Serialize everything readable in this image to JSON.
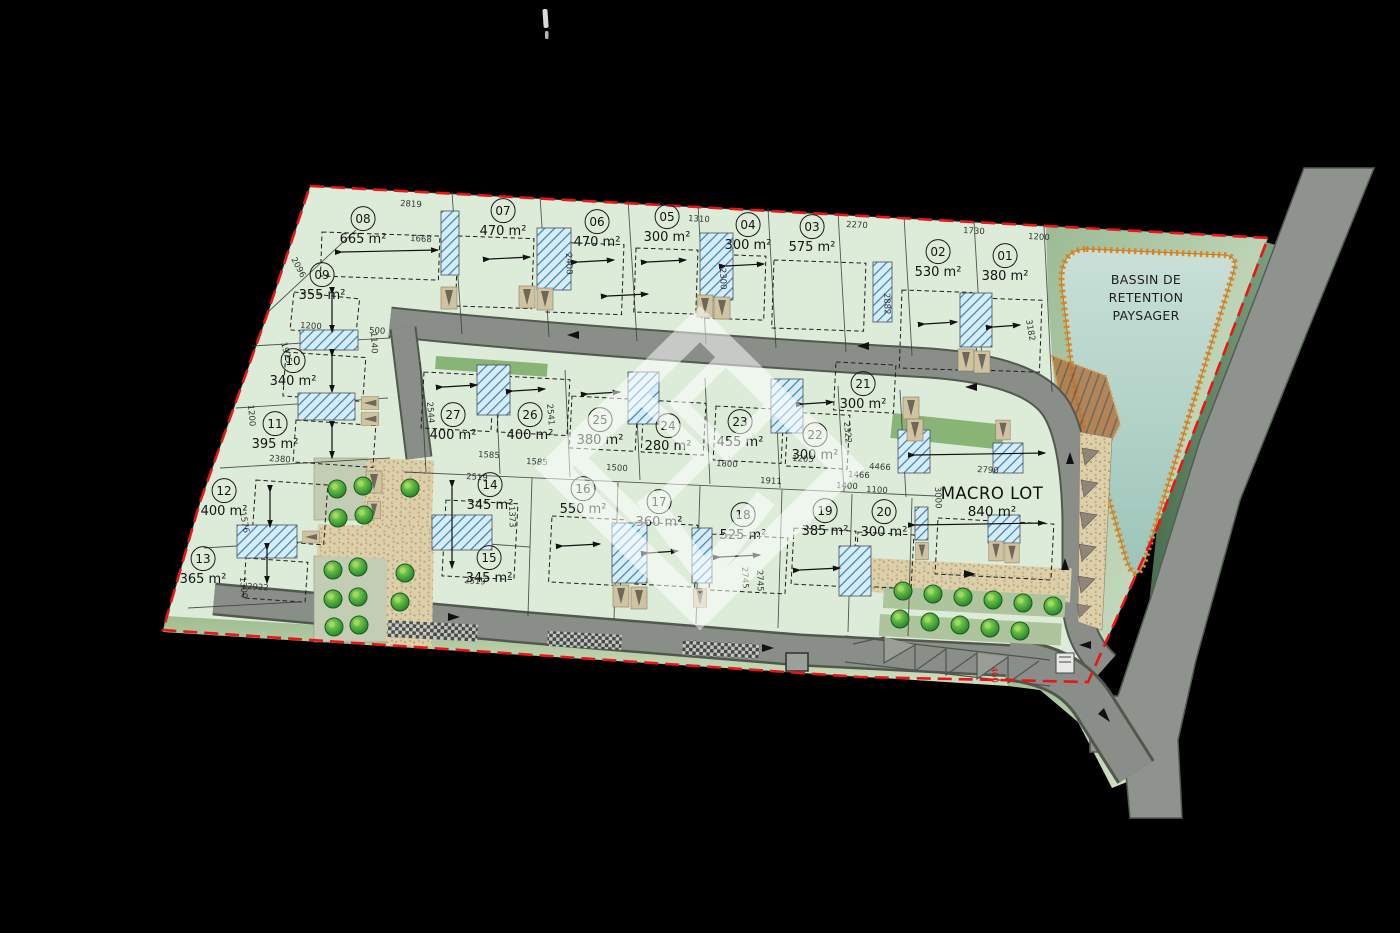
{
  "plan": {
    "bassin": {
      "line1": "BASSIN DE",
      "line2": "RETENTION",
      "line3": "PAYSAGER"
    },
    "macro_lot": {
      "label": "MACRO LOT",
      "area": "840 m²"
    },
    "lots": [
      {
        "number": "01",
        "area": "380 m²"
      },
      {
        "number": "02",
        "area": "530 m²"
      },
      {
        "number": "03",
        "area": "575 m²"
      },
      {
        "number": "04",
        "area": "300 m²"
      },
      {
        "number": "05",
        "area": "300 m²"
      },
      {
        "number": "06",
        "area": "470 m²"
      },
      {
        "number": "07",
        "area": "470 m²"
      },
      {
        "number": "08",
        "area": "665 m²"
      },
      {
        "number": "09",
        "area": "355 m²"
      },
      {
        "number": "10",
        "area": "340 m²"
      },
      {
        "number": "11",
        "area": "395 m²"
      },
      {
        "number": "12",
        "area": "400 m²"
      },
      {
        "number": "13",
        "area": "365 m²"
      },
      {
        "number": "14",
        "area": "345 m²"
      },
      {
        "number": "15",
        "area": "345 m²"
      },
      {
        "number": "16",
        "area": "550 m²"
      },
      {
        "number": "17",
        "area": "360 m²"
      },
      {
        "number": "18",
        "area": "525 m²"
      },
      {
        "number": "19",
        "area": "385 m²"
      },
      {
        "number": "20",
        "area": "300 m²"
      },
      {
        "number": "21",
        "area": "300 m²"
      },
      {
        "number": "22",
        "area": "300 m²"
      },
      {
        "number": "23",
        "area": "455 m²"
      },
      {
        "number": "24",
        "area": "280 m²"
      },
      {
        "number": "25",
        "area": "380 m²"
      },
      {
        "number": "26",
        "area": "400 m²"
      },
      {
        "number": "27",
        "area": "400 m²"
      }
    ],
    "dims": [
      "2819",
      "1668",
      "2096",
      "1975",
      "1140",
      "1310",
      "2270",
      "1730",
      "1200",
      "2400",
      "2300",
      "2882",
      "3182",
      "1585",
      "1585",
      "2519",
      "2519",
      "1373",
      "2745",
      "2745",
      "1400",
      "1100",
      "1800",
      "1500",
      "1911",
      "2380",
      "1576",
      "1300",
      "2922",
      "4466",
      "2790",
      "3000",
      "2544",
      "2541",
      "1205",
      "2322",
      "1466",
      "1200",
      "500",
      "1200"
    ],
    "red_dim": "400",
    "colors": {
      "boundary": "#ea1515",
      "site": "#dcecd9",
      "road": "#898e89",
      "water": "#aed0c4",
      "basin_edge": "#d98a2e",
      "hatch_blue": "#3285b5",
      "gravel": "#dccfa9",
      "tree": "#3f9f36"
    }
  }
}
